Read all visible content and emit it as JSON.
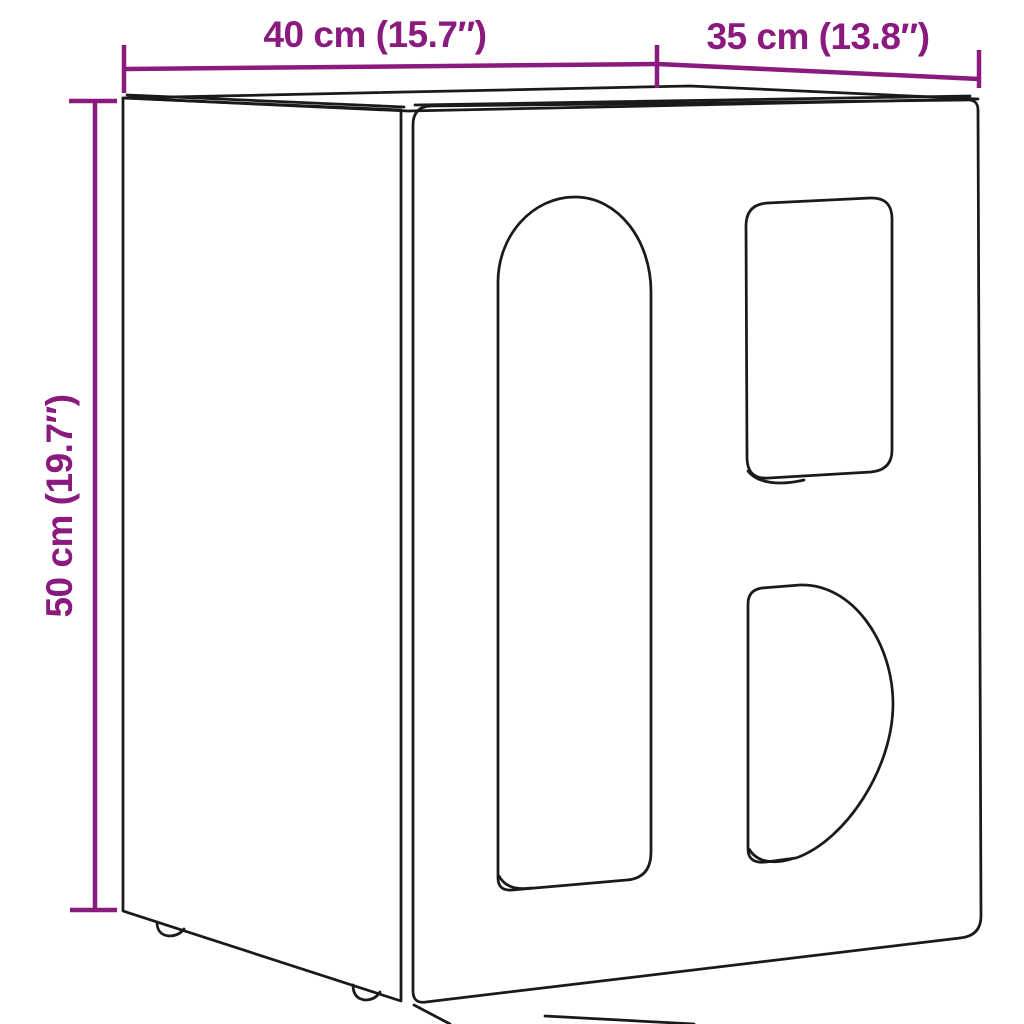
{
  "colors": {
    "background": "#FFFFFF",
    "line": "#1A1A1A",
    "accent": "#8A1A7E"
  },
  "diagram": {
    "type": "product-dimension-drawing",
    "object": "cabinet with arch, rounded-rectangle and half-circle cutouts"
  },
  "dimensions": {
    "width": {
      "label": "40 cm (15.7″)"
    },
    "depth": {
      "label": "35 cm (13.8″)"
    },
    "height": {
      "label": "50 cm (19.7″)"
    }
  }
}
